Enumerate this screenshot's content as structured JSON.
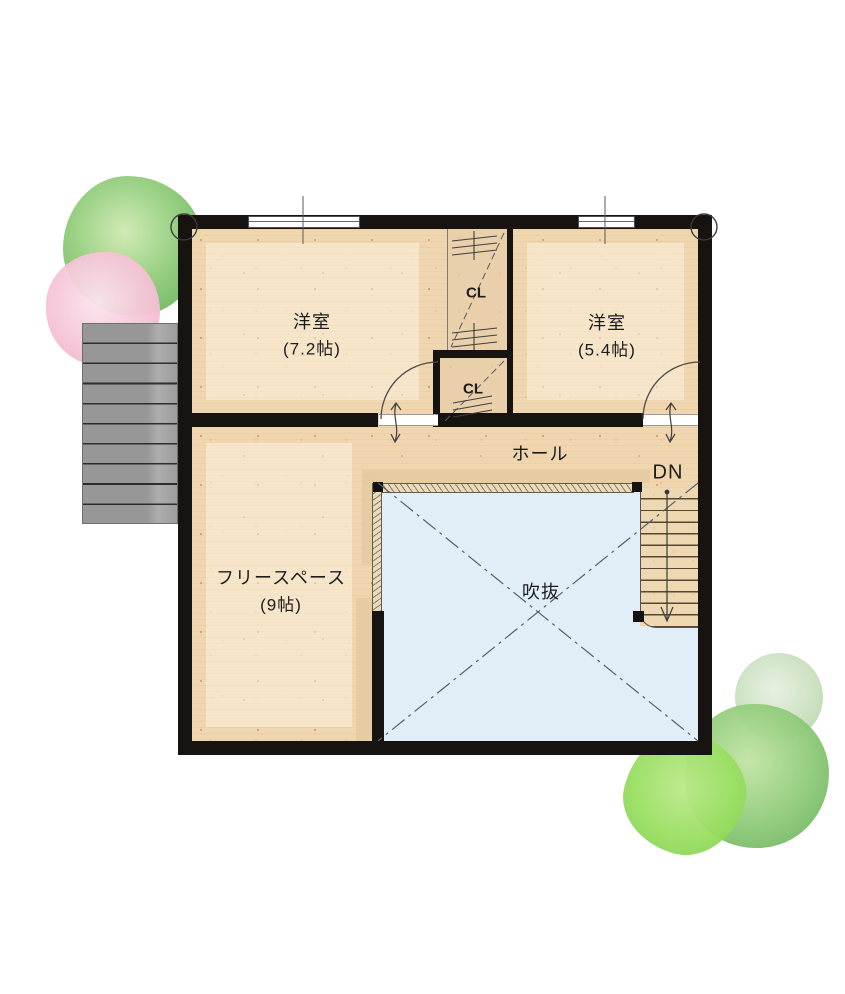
{
  "plan": {
    "title": "2F floor plan",
    "rooms": [
      {
        "name": "洋室",
        "size": "(7.2帖)"
      },
      {
        "name": "洋室",
        "size": "(5.4帖)"
      },
      {
        "name": "フリースペース",
        "size": "(9帖)"
      }
    ],
    "labels": {
      "hall": "ホール",
      "void": "吹抜",
      "down": "DN",
      "closet_upper": "CL",
      "closet_lower": "CL"
    },
    "colors": {
      "wall": "#171310",
      "floor_wood": "#efd6af",
      "closet_wood": "#e9d0aa",
      "void_blue": "#e2eef7",
      "roof_gray": "#979797",
      "tree_green": "#77bd66",
      "tree_pink": "#f5c4d7"
    }
  }
}
